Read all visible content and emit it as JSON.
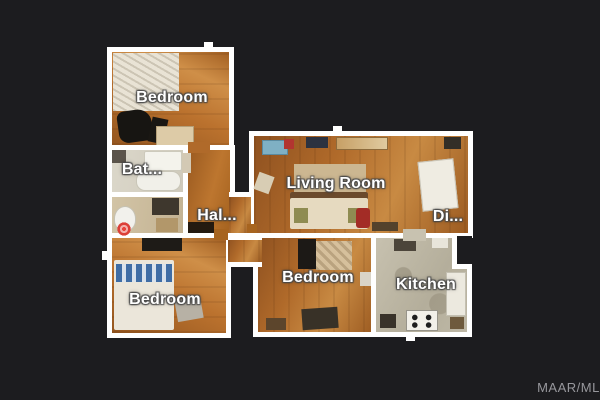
{
  "page": {
    "background_color": "#1c1c1f",
    "wall_color": "#ffffff",
    "floor_wood_color": "#b06a2a",
    "floor_tile_color": "#beb8a6"
  },
  "rooms": [
    {
      "id": "bedroom-top-left",
      "label": "Bedroom"
    },
    {
      "id": "bathroom",
      "label": "Bat..."
    },
    {
      "id": "hall",
      "label": "Hal..."
    },
    {
      "id": "living-room",
      "label": "Living Room"
    },
    {
      "id": "dining-room",
      "label": "Di..."
    },
    {
      "id": "bedroom-bottom-left",
      "label": "Bedroom"
    },
    {
      "id": "bedroom-middle",
      "label": "Bedroom"
    },
    {
      "id": "kitchen",
      "label": "Kitchen"
    }
  ],
  "marker": {
    "name": "360-view-point",
    "color": "#dc3f38"
  },
  "watermark": {
    "text": "MAAR/MLS"
  }
}
